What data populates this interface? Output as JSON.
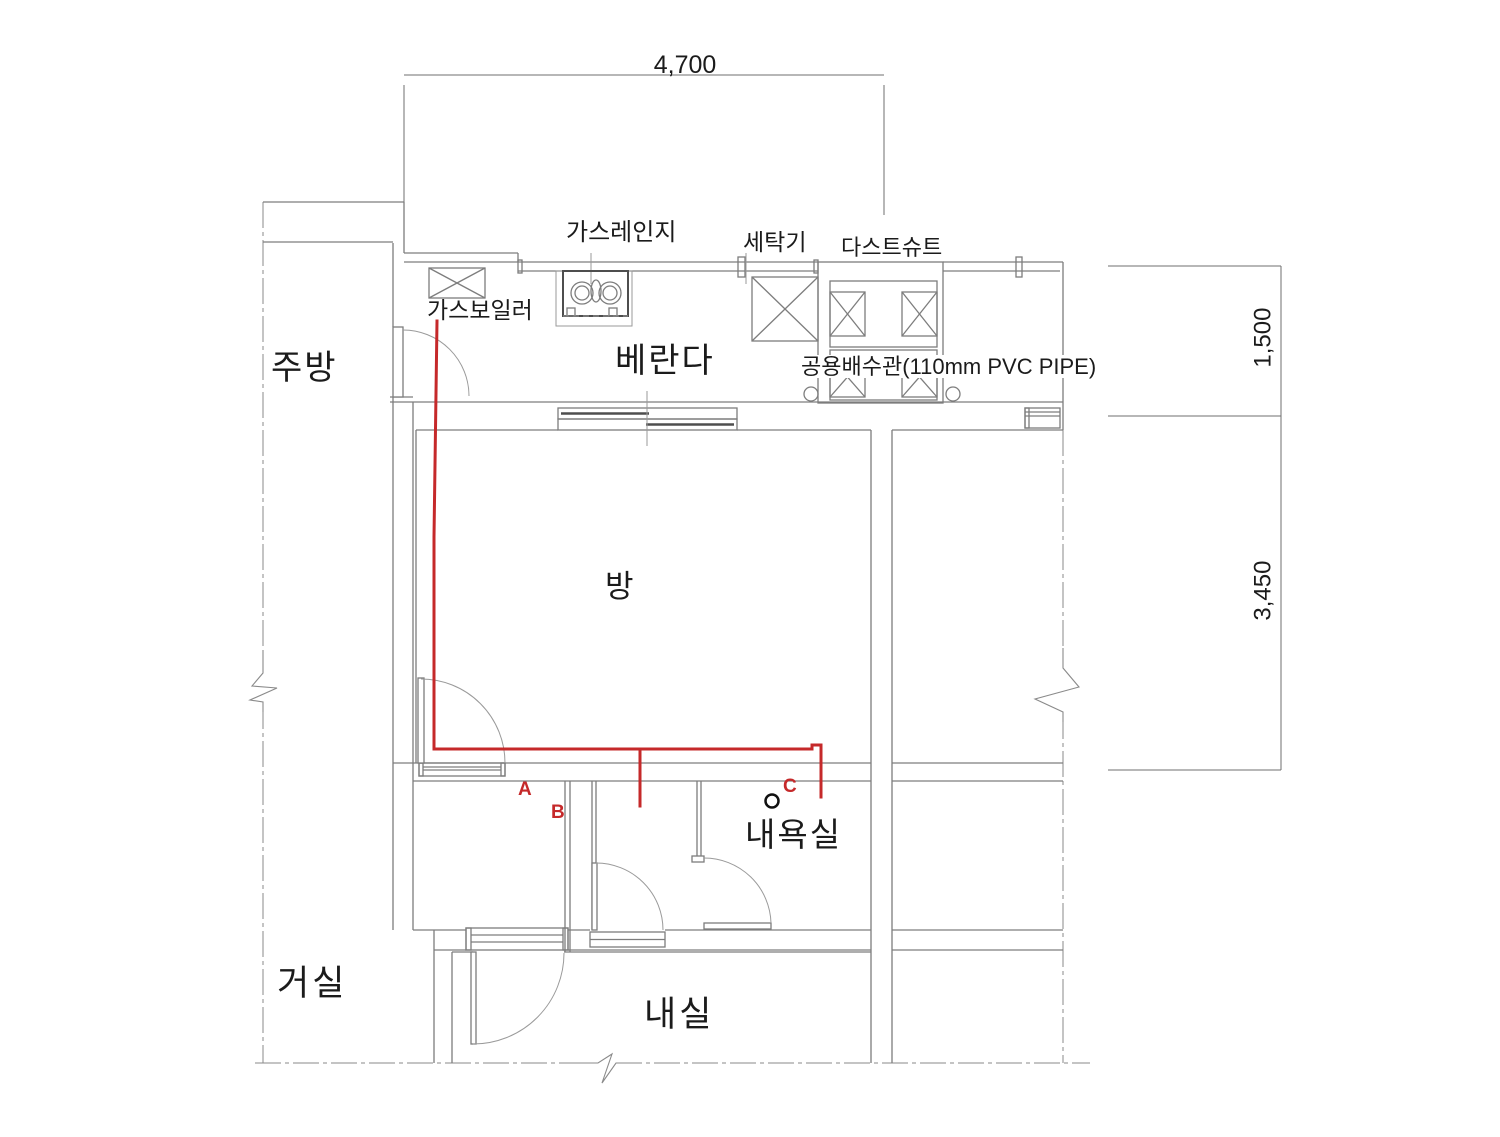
{
  "page": {
    "type": "architectural floor plan (partial unit plan with piping annotation)"
  },
  "dimensions": {
    "top_width": "4,700",
    "right_upper_height": "1,500",
    "right_lower_height": "3,450"
  },
  "rooms": {
    "kitchen": "주방",
    "veranda": "베란다",
    "room": "방",
    "living_room": "거실",
    "inner_room": "내실",
    "bathroom": "내욕실"
  },
  "equipment": {
    "gas_range": "가스레인지",
    "washing_machine": "세탁기",
    "dust_chute": "다스트슈트",
    "gas_boiler": "가스보일러",
    "drain_pipe_note": "공용배수관(110mm PVC PIPE)"
  },
  "markers": {
    "a": "A",
    "b": "B",
    "c": "C"
  },
  "colors": {
    "annotation_red": "#c5292a",
    "line_gray": "#7d7d7d",
    "dim_gray": "#6f6f6f",
    "text_black": "#1b1b1b",
    "background": "#ffffff"
  }
}
